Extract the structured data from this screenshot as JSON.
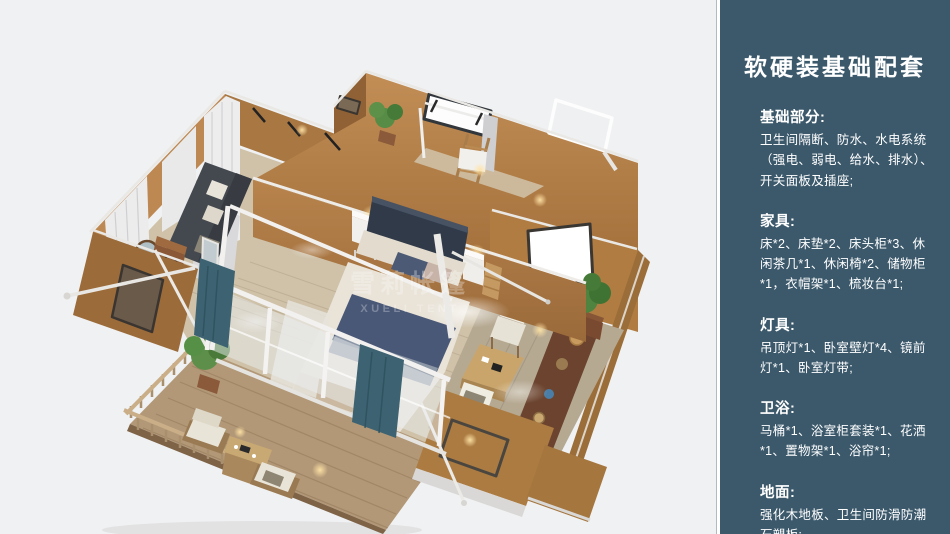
{
  "sidebar": {
    "title": "软硬装基础配套",
    "sections": [
      {
        "heading": "基础部分:",
        "body": "卫生间隔断、防水、水电系统（强电、弱电、给水、排水）、开关面板及插座;"
      },
      {
        "heading": "家具:",
        "body": "床*2、床垫*2、床头柜*3、休闲茶几*1、休闲椅*2、储物柜*1，衣帽架*1、梳妆台*1;"
      },
      {
        "heading": "灯具:",
        "body": "吊顶灯*1、卧室壁灯*4、镜前灯*1、卧室灯带;"
      },
      {
        "heading": "卫浴:",
        "body": "马桶*1、浴室柜套装*1、花洒*1、置物架*1、浴帘*1;"
      },
      {
        "heading": "地面:",
        "body": "强化木地板、卫生间防滑防潮石塑板;"
      }
    ]
  },
  "scene": {
    "watermark_line1": "雪莉帐篷",
    "watermark_line2": "XUELI TENT"
  },
  "colors": {
    "panel_bg": "#3c596c",
    "panel_text": "#ffffff",
    "panel_edge": "#ffffff",
    "canvas_bg": "#f0f1f2",
    "wall_tan": "#b5824a",
    "wood_floor": "#cfc2a9",
    "deck_wood": "#b29877",
    "bed_navy": "#4a5877",
    "curtain_teal": "#3d6271"
  }
}
